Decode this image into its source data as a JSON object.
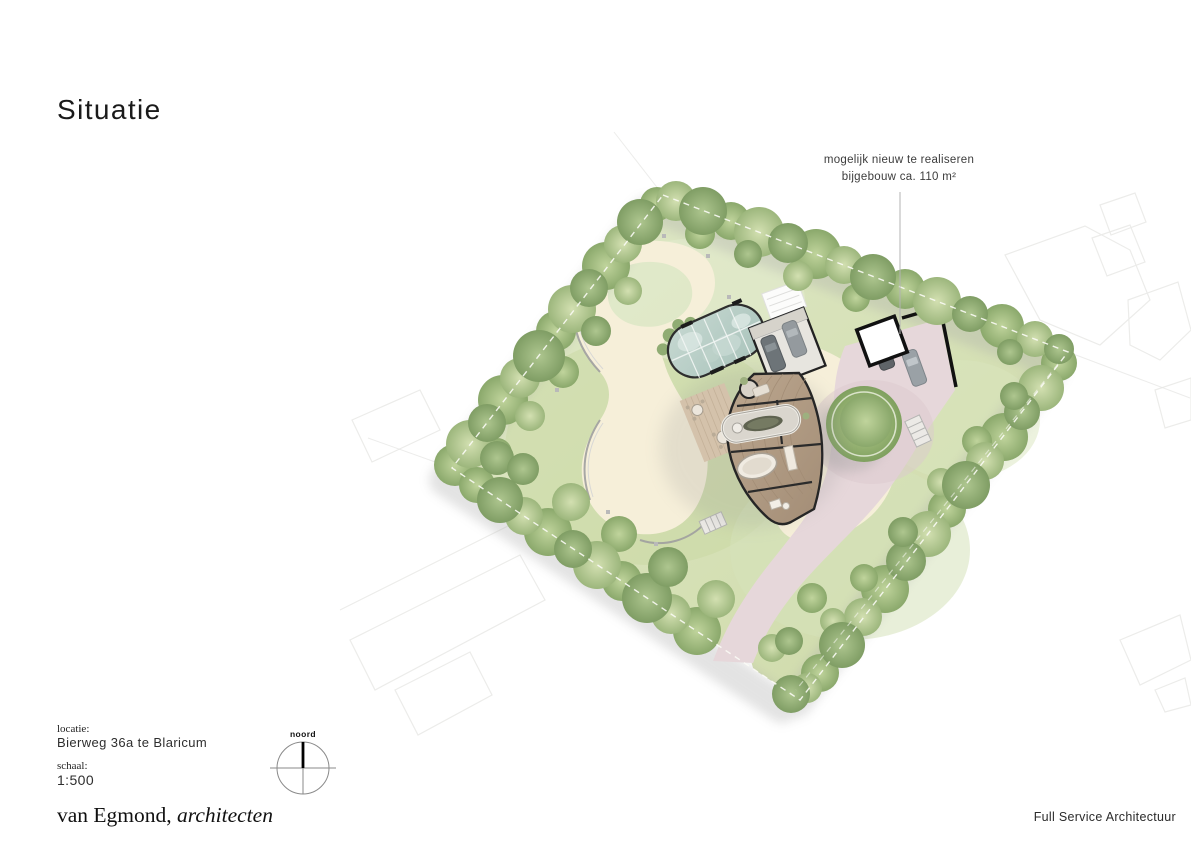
{
  "header": {
    "title": "Situatie"
  },
  "annotation": {
    "line1": "mogelijk nieuw te realiseren",
    "line2": "bijgebouw ca. 110 m²"
  },
  "compass": {
    "label": "noord"
  },
  "meta": {
    "locatie_label": "locatie:",
    "locatie_value": "Bierweg 36a te Blaricum",
    "schaal_label": "schaal:",
    "schaal_value": "1:500"
  },
  "footer": {
    "logo_regular": "van Egmond,",
    "logo_italic": " architecten",
    "tagline": "Full Service Architectuur"
  },
  "colors": {
    "lawn": "#d3dfae",
    "trees": "#9cb67c",
    "path": "#f6efd9",
    "driveway": "#e6d7da",
    "glass_roof": "#b8cfc7",
    "wood_floor": "#b2a08a",
    "wall": "#222222"
  }
}
